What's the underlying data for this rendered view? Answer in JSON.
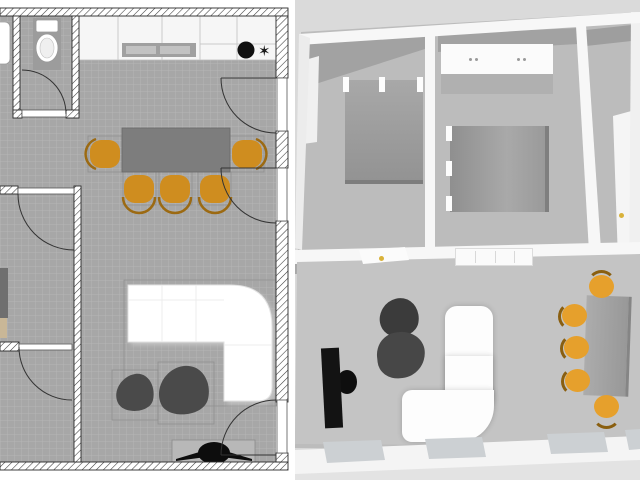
{
  "image": {
    "width": 640,
    "height": 480
  },
  "plan2d": {
    "colors": {
      "floor": "#a7a7a7",
      "grid_line": "#b5b5b5",
      "wall_fill": "#ffffff",
      "wall_stroke": "#2b2b2b",
      "wall_hatch": "#3a3a3a",
      "counter": "#f6f6f6",
      "cooktop": "#a0a0a0",
      "cooktop_inner": "#c2c2c2",
      "sink": "#101010",
      "faucet": "#1a1a1a",
      "table": "#7d7d7d",
      "chair": "#cf8d1f",
      "chair_back": "#9c6a12",
      "sofa": "#ffffff",
      "pouf": "#4a4a4a",
      "tv": "#0d0d0d",
      "tv_console": "#b8b8b8",
      "bed": "#6f6f6f",
      "bed_foot": "#c9b797",
      "toilet": "#ffffff",
      "toilet_pad": "#9c9c9c"
    },
    "faucet_glyph": "✶",
    "rooms": [
      {
        "name": "wc"
      },
      {
        "name": "kitchen"
      },
      {
        "name": "dining-area"
      },
      {
        "name": "bedroom"
      },
      {
        "name": "storage-room"
      },
      {
        "name": "living-room"
      }
    ],
    "furniture": [
      {
        "name": "toilet",
        "count": 1
      },
      {
        "name": "washbasin-partial",
        "count": 1
      },
      {
        "name": "kitchen-counter",
        "count": 1
      },
      {
        "name": "cooktop",
        "count": 1
      },
      {
        "name": "kitchen-sink",
        "count": 1
      },
      {
        "name": "dining-table",
        "count": 1
      },
      {
        "name": "dining-chair",
        "count": 5
      },
      {
        "name": "sectional-sofa",
        "count": 1
      },
      {
        "name": "pouf",
        "count": 2
      },
      {
        "name": "tv-on-console",
        "count": 1
      },
      {
        "name": "bed-partial",
        "count": 1
      },
      {
        "name": "door-swing",
        "count": 6
      }
    ]
  },
  "plan3d": {
    "colors": {
      "background": "#dadada",
      "floor": "#bcbcbc",
      "floor_living": "#c4c4c4",
      "wall": "#f7f7f7",
      "wall_shadow": "#a2a2a2",
      "bed": "#9d9d9d",
      "wardrobe": "#fbfbfb",
      "sideboard": "#fafafa",
      "chair": "#e6a02c",
      "chair_back": "#8a5f10",
      "table": "#a0a0a0",
      "sofa": "#fdfdfd",
      "pouf": "#414141",
      "tv": "#131313",
      "door_handle": "#d9b23a",
      "window": "#ccd0d3"
    },
    "rooms": [
      {
        "name": "bedroom-1"
      },
      {
        "name": "bedroom-2"
      },
      {
        "name": "hall-room"
      },
      {
        "name": "living-dining-room"
      }
    ],
    "furniture": [
      {
        "name": "double-bed",
        "count": 2
      },
      {
        "name": "wardrobe",
        "count": 1
      },
      {
        "name": "sideboard",
        "count": 1
      },
      {
        "name": "wall-tv",
        "count": 1
      },
      {
        "name": "pouf",
        "count": 2
      },
      {
        "name": "sectional-sofa",
        "count": 1
      },
      {
        "name": "dining-table",
        "count": 1
      },
      {
        "name": "dining-chair",
        "count": 5
      },
      {
        "name": "open-door",
        "count": 2
      },
      {
        "name": "window",
        "count": 5
      }
    ]
  }
}
